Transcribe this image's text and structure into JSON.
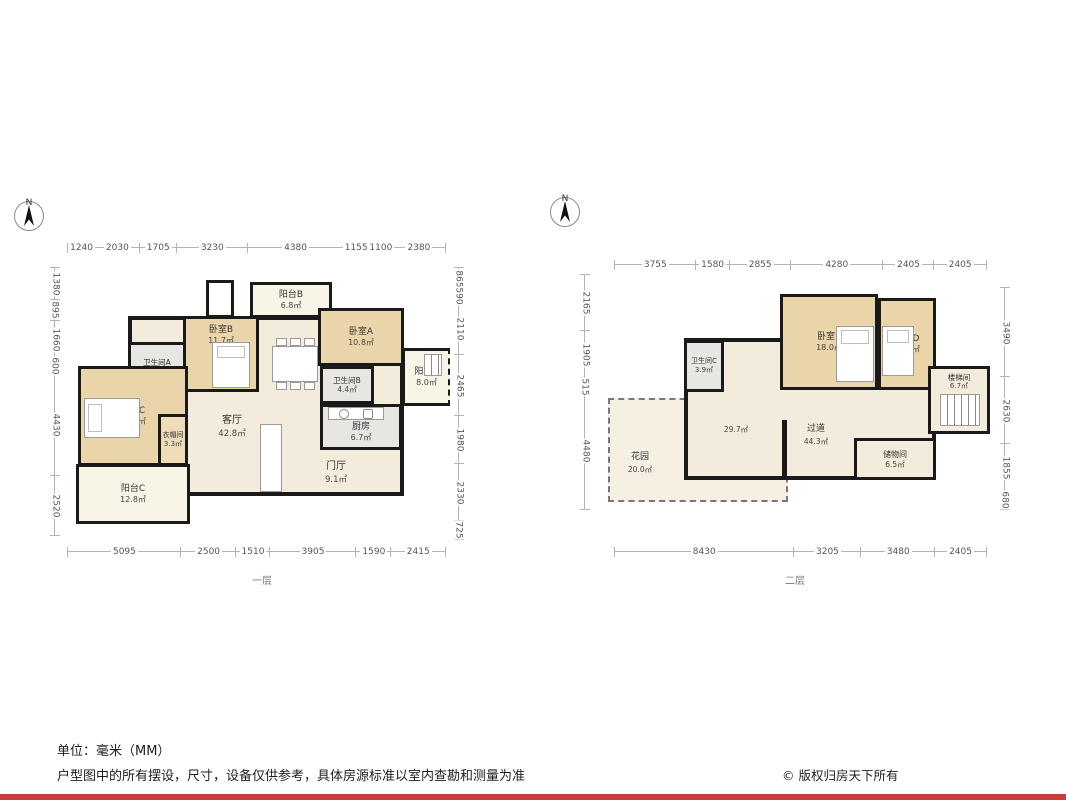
{
  "north_label": "N",
  "colors": {
    "wall": "#1a1a1a",
    "bedroom_fill": "#ead5aa",
    "living_fill": "#f3ecdc",
    "wet_fill": "#e7e6e3",
    "balcony_fill": "#f8f4e6",
    "bottom_bar_red": "#c5403c"
  },
  "footer": {
    "unit_note": "单位：毫米（MM）",
    "disclaimer": "户型图中的所有摆设，尺寸，设备仅供参考，具体房源标准以室内查勘和测量为准",
    "copyright": "© 版权归房天下所有"
  },
  "plans": [
    {
      "floor_label": "一层",
      "dims": {
        "top": [
          "1240",
          "2030",
          "1705",
          "3230",
          "4380",
          "1155",
          "1100",
          "2380"
        ],
        "bottom": [
          "5095",
          "2500",
          "1510",
          "3905",
          "1590",
          "2415"
        ],
        "left": [
          "1380",
          "895",
          "1660",
          "600",
          "4430",
          "2520"
        ],
        "right": [
          "865",
          "590",
          "2110",
          "2465",
          "1980",
          "2330",
          "725"
        ]
      },
      "rooms": [
        {
          "name": "阳台B",
          "area": "6.8㎡"
        },
        {
          "name": "卧室B",
          "area": "11.7㎡"
        },
        {
          "name": "卧室A",
          "area": "10.8㎡"
        },
        {
          "name": "卫生间A",
          "area": "4.6㎡"
        },
        {
          "name": "卧室C",
          "area": "19.2㎡"
        },
        {
          "name": "衣帽间",
          "area": "3.3㎡"
        },
        {
          "name": "客厅",
          "area": "42.8㎡"
        },
        {
          "name": "卫生间B",
          "area": "4.4㎡"
        },
        {
          "name": "厨房",
          "area": "6.7㎡"
        },
        {
          "name": "阳台A",
          "area": "8.0㎡"
        },
        {
          "name": "门厅",
          "area": "9.1㎡"
        },
        {
          "name": "阳台C",
          "area": "12.8㎡"
        }
      ]
    },
    {
      "floor_label": "二层",
      "dims": {
        "top": [
          "3755",
          "1580",
          "2855",
          "4280",
          "2405",
          "2405"
        ],
        "bottom": [
          "8430",
          "3205",
          "3480",
          "2405"
        ],
        "left": [
          "2165",
          "1905",
          "515",
          "4480"
        ],
        "right": [
          "3490",
          "2630",
          "1855",
          "680"
        ]
      },
      "rooms": [
        {
          "name": "卧室E",
          "area": "18.0㎡"
        },
        {
          "name": "卧室D",
          "area": "10.1㎡"
        },
        {
          "name": "卫生间C",
          "area": "3.9㎡"
        },
        {
          "name": "楼梯间",
          "area": "6.7㎡"
        },
        {
          "name": "",
          "area": "29.7㎡"
        },
        {
          "name": "过道",
          "area": "44.3㎡"
        },
        {
          "name": "储物间",
          "area": "6.5㎡"
        },
        {
          "name": "花园",
          "area": "20.0㎡"
        }
      ]
    }
  ]
}
